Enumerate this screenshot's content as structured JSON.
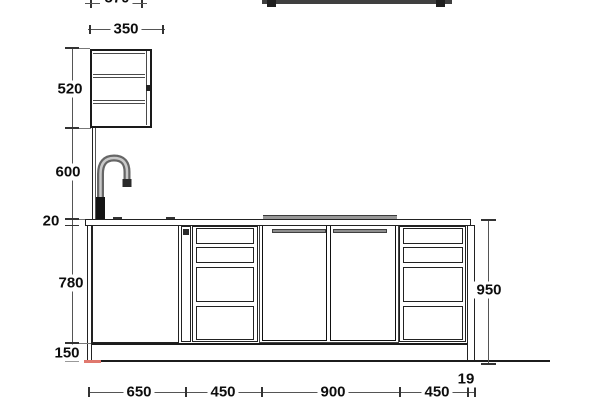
{
  "drawing": {
    "type": "kitchen-elevation-cad",
    "colors": {
      "line": "#1c1c1c",
      "dimension_text": "#0d0d0d",
      "handle_gray": "#8d8d8d",
      "hob_gray": "#979797",
      "red_marker": "#e0786e"
    },
    "dims": {
      "top_clipped_width": "570",
      "wall_cabinet_width": "350",
      "wall_cabinet_height": "520",
      "wall_to_worktop_gap": "600",
      "worktop_thickness": "20",
      "base_cabinet_height": "780",
      "plinth_height": "150",
      "worktop_to_floor": "950",
      "end_panel_thickness": "19",
      "bottom_segments": [
        "650",
        "450",
        "900",
        "450"
      ]
    }
  }
}
